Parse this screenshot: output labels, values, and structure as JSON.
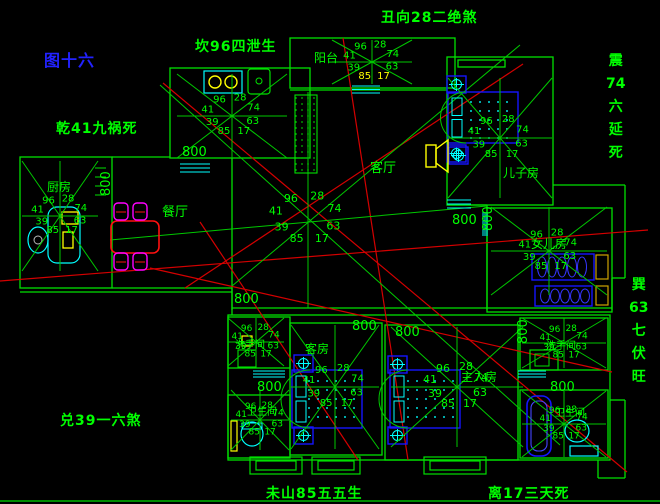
{
  "figure_title": "图十六",
  "compass": {
    "facing_top": "丑向28二绝煞",
    "north": "坎96四泄生",
    "northwest": "乾41九祸死",
    "west": "兑39一六煞",
    "sitting_bottom": "未山85五五生",
    "south_bottom": "离17三天死",
    "east_col": [
      "震",
      "74",
      "六",
      "延",
      "死"
    ],
    "southeast_col": [
      "巽",
      "63",
      "七",
      "伏",
      "旺"
    ]
  },
  "rooms": {
    "balcony": "阳台",
    "living": "客厅",
    "dining": "餐厅",
    "kitchen": "厨房",
    "son": "儿子房",
    "daughter": "女儿房",
    "guest": "客房",
    "master": "主人房",
    "washroom_a": "洗手间",
    "bathroom_b": "卫生间",
    "washroom_c": "洗手间",
    "bathroom_d": "卫生间"
  },
  "star_numbers": [
    "96",
    "28",
    "41",
    "74",
    "39",
    "63",
    "85",
    "17"
  ],
  "dimension": "800",
  "colors": {
    "wall_green": "#00e000",
    "ray_green": "#00c800",
    "text_green": "#00ff00",
    "sector_red": "#d40000",
    "furniture_red": "#ff1010",
    "cyan": "#00ffff",
    "blue": "#1515ff",
    "yellow": "#ffff00",
    "magenta": "#ff00ff",
    "title_blue": "#2222ff"
  }
}
